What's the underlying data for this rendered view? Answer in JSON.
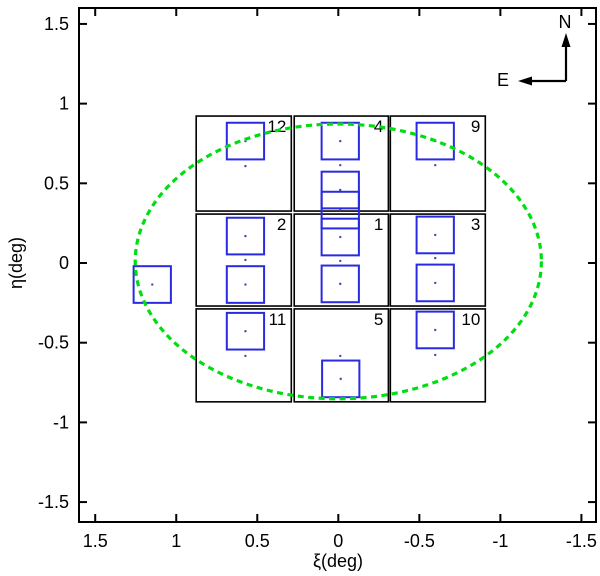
{
  "figure": {
    "x_axis_title": "ξ(deg)",
    "y_axis_title": "η(deg)",
    "compass": {
      "north": "N",
      "east": "E"
    }
  },
  "chart_data": {
    "type": "scatter",
    "title": "",
    "xlabel": "ξ(deg)",
    "ylabel": "η(deg)",
    "x_range": [
      1.6,
      -1.59
    ],
    "y_range": [
      1.6,
      -1.625
    ],
    "x_axis_reversed": true,
    "grid": false,
    "legend": "none",
    "x_ticks": {
      "values": [
        1.5,
        1,
        0.5,
        0,
        -0.5,
        -1,
        -1.5
      ],
      "labels": [
        "1.5",
        "1",
        "0.5",
        "0",
        "-0.5",
        "-1",
        "-1.5"
      ]
    },
    "y_ticks": {
      "values": [
        1.5,
        1,
        0.5,
        0,
        -0.5,
        -1,
        -1.5
      ],
      "labels": [
        "1.5",
        "1",
        "0.5",
        "0",
        "-0.5",
        "-1",
        "-1.5"
      ]
    },
    "ellipse": {
      "cx": 0.0,
      "cy": 0.01,
      "rx": 1.253,
      "ry": 0.862,
      "style": "dashed",
      "color": "#00dd11"
    },
    "fields": [
      {
        "label": "12",
        "xi": [
          0.877,
          0.29
        ],
        "eta": [
          0.922,
          0.326
        ]
      },
      {
        "label": "4",
        "xi": [
          0.272,
          -0.309
        ],
        "eta": [
          0.922,
          0.326
        ]
      },
      {
        "label": "9",
        "xi": [
          -0.321,
          -0.907
        ],
        "eta": [
          0.922,
          0.326
        ]
      },
      {
        "label": "2",
        "xi": [
          0.877,
          0.29
        ],
        "eta": [
          0.307,
          -0.27
        ]
      },
      {
        "label": "1",
        "xi": [
          0.272,
          -0.309
        ],
        "eta": [
          0.307,
          -0.27
        ]
      },
      {
        "label": "3",
        "xi": [
          -0.321,
          -0.907
        ],
        "eta": [
          0.307,
          -0.27
        ]
      },
      {
        "label": "11",
        "xi": [
          0.877,
          0.29
        ],
        "eta": [
          -0.288,
          -0.871
        ]
      },
      {
        "label": "5",
        "xi": [
          0.272,
          -0.309
        ],
        "eta": [
          -0.288,
          -0.871
        ]
      },
      {
        "label": "10",
        "xi": [
          -0.321,
          -0.907
        ],
        "eta": [
          -0.288,
          -0.871
        ]
      }
    ],
    "pointings": {
      "size_deg": 0.23,
      "color": "#2a2ae0",
      "centers": [
        [
          1.148,
          -0.135
        ],
        [
          0.573,
          0.765
        ],
        [
          0.573,
          0.169
        ],
        [
          0.573,
          -0.135
        ],
        [
          0.573,
          -0.428
        ],
        [
          -0.012,
          0.765
        ],
        [
          -0.012,
          0.458
        ],
        [
          -0.012,
          0.332
        ],
        [
          -0.012,
          0.163
        ],
        [
          -0.012,
          -0.131
        ],
        [
          -0.015,
          -0.727
        ],
        [
          -0.598,
          0.765
        ],
        [
          -0.598,
          0.176
        ],
        [
          -0.598,
          -0.125
        ],
        [
          -0.598,
          -0.42
        ]
      ]
    },
    "extra_dots": [
      [
        0.573,
        0.608
      ],
      [
        -0.012,
        0.614
      ],
      [
        -0.598,
        0.614
      ],
      [
        0.573,
        0.019
      ],
      [
        -0.012,
        0.013
      ],
      [
        -0.598,
        0.031
      ],
      [
        0.573,
        -0.583
      ],
      [
        -0.012,
        -0.583
      ],
      [
        -0.598,
        -0.577
      ]
    ],
    "compass": {
      "north": "N",
      "east": "E",
      "origin_px": [
        566,
        81
      ],
      "arm_px": 48
    },
    "colors": {
      "axis": "#000000",
      "field_outline": "#000000",
      "pointing": "#2a2ae0",
      "ellipse": "#00dd11",
      "dot": "#4747ab",
      "background": "#ffffff"
    }
  }
}
